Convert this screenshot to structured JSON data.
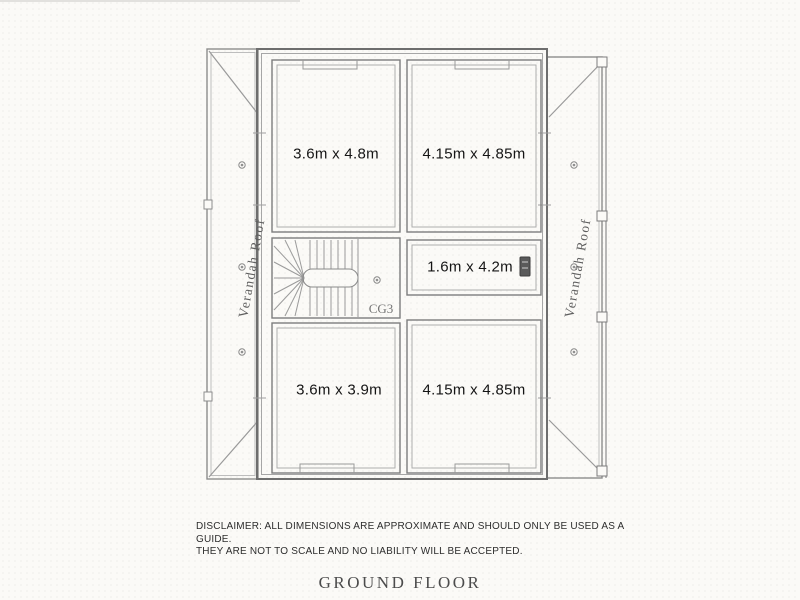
{
  "plan": {
    "rooms": [
      {
        "id": "bedroom-top-left",
        "label": "3.6m x 4.8m"
      },
      {
        "id": "bedroom-top-right",
        "label": "4.15m x 4.85m"
      },
      {
        "id": "room-mid-right",
        "label": "1.6m x 4.2m"
      },
      {
        "id": "bedroom-bottom-left",
        "label": "3.6m x 3.9m"
      },
      {
        "id": "bedroom-bottom-right",
        "label": "4.15m x 4.85m"
      }
    ],
    "stair": {
      "label": "CG3"
    },
    "verandah_left": {
      "label": "Verandah Roof"
    },
    "verandah_right": {
      "label": "Verandah Roof"
    },
    "icons": {
      "downlight": "downlight-circle",
      "post": "verandah-post-square",
      "wall_badge": "dark-wall-badge"
    },
    "colors": {
      "wall": "#6e6e6e",
      "line": "#8d8d8d",
      "light_line": "#ababab",
      "label_text": "#141414",
      "paper": "#fbfaf7"
    }
  },
  "footer": {
    "disclaimer_line1": "DISCLAIMER: ALL DIMENSIONS ARE APPROXIMATE AND SHOULD ONLY BE USED AS A GUIDE.",
    "disclaimer_line2": "THEY ARE NOT TO SCALE AND NO LIABILITY WILL BE ACCEPTED.",
    "title": "GROUND FLOOR"
  }
}
